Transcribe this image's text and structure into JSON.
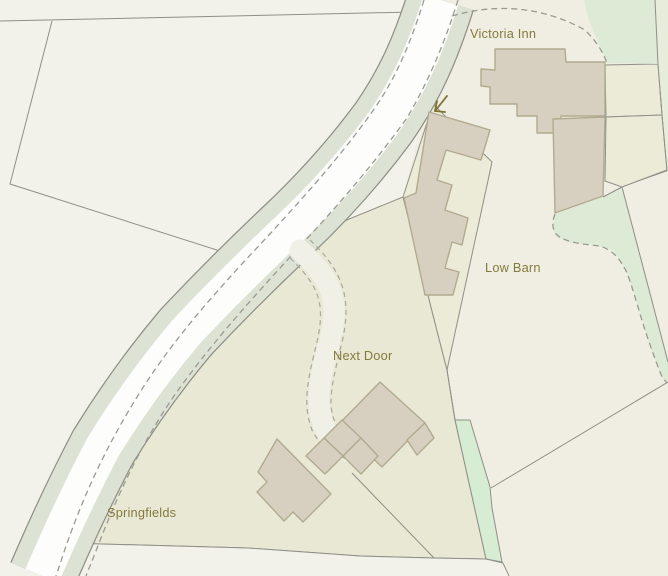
{
  "map": {
    "kind": "parcel-and-building-map",
    "labels": {
      "victoria_inn": "Victoria Inn",
      "low_barn": "Low Barn",
      "next_door": "Next Door",
      "springfields": "Springfields"
    },
    "palette": {
      "field_pale": "#f2f2eb",
      "field_cream": "#f0eee2",
      "parcel_yellow": "#e9e8d4",
      "green_parcel": "#dcead6",
      "green_strip": "#d6ecd3",
      "road_verge_green": "#dde3d4",
      "road_white": "#fdfdfc",
      "building_fill": "#d7d0c1",
      "building_outline": "#b2aa8f",
      "boundary_gray": "#8f8f88",
      "label_olive": "#847a3e"
    }
  }
}
